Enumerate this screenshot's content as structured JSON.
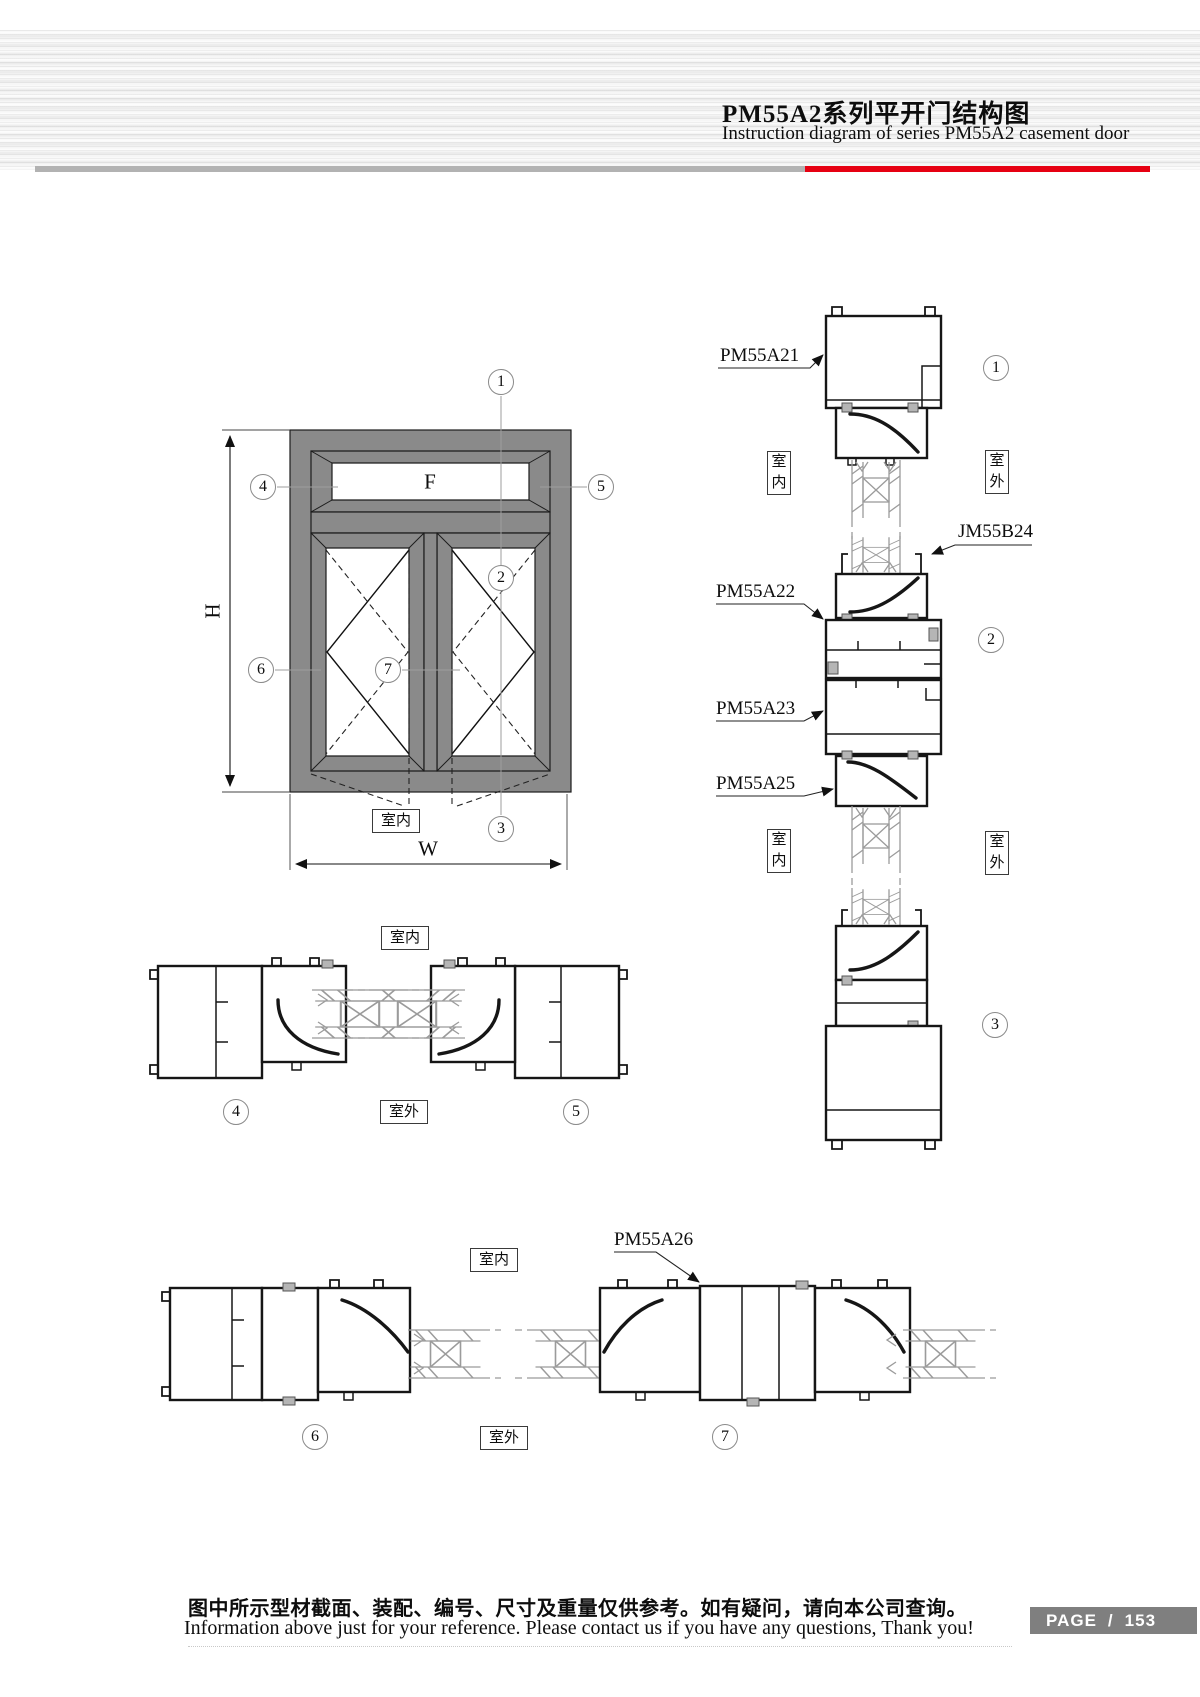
{
  "header": {
    "title_zh": "PM55A2系列平开门结构图",
    "title_en": "Instruction diagram of series PM55A2 casement door"
  },
  "labels": {
    "indoor": "室内",
    "outdoor": "室外",
    "dim_height": "H",
    "dim_width": "W",
    "fixed_panel": "F"
  },
  "callouts": {
    "c1": "1",
    "c2": "2",
    "c3": "3",
    "c4": "4",
    "c5": "5",
    "c6": "6",
    "c7": "7"
  },
  "profiles": {
    "pm55a21": "PM55A21",
    "jm55b24": "JM55B24",
    "pm55a22": "PM55A22",
    "pm55a23": "PM55A23",
    "pm55a25": "PM55A25",
    "pm55a26": "PM55A26"
  },
  "footer": {
    "note_zh": "图中所示型材截面、装配、编号、尺寸及重量仅供参考。如有疑问，请向本公司查询。",
    "note_en": "Information above just for your reference. Please contact us if you have any questions, Thank you!",
    "page_label": "PAGE",
    "page_separator": "/",
    "page_number": "153"
  },
  "colors": {
    "accent_red": "#e60012",
    "divider_gray": "#b2b2b2",
    "frame_gray": "#8a8a8a",
    "badge_gray": "#7f7f7f"
  }
}
